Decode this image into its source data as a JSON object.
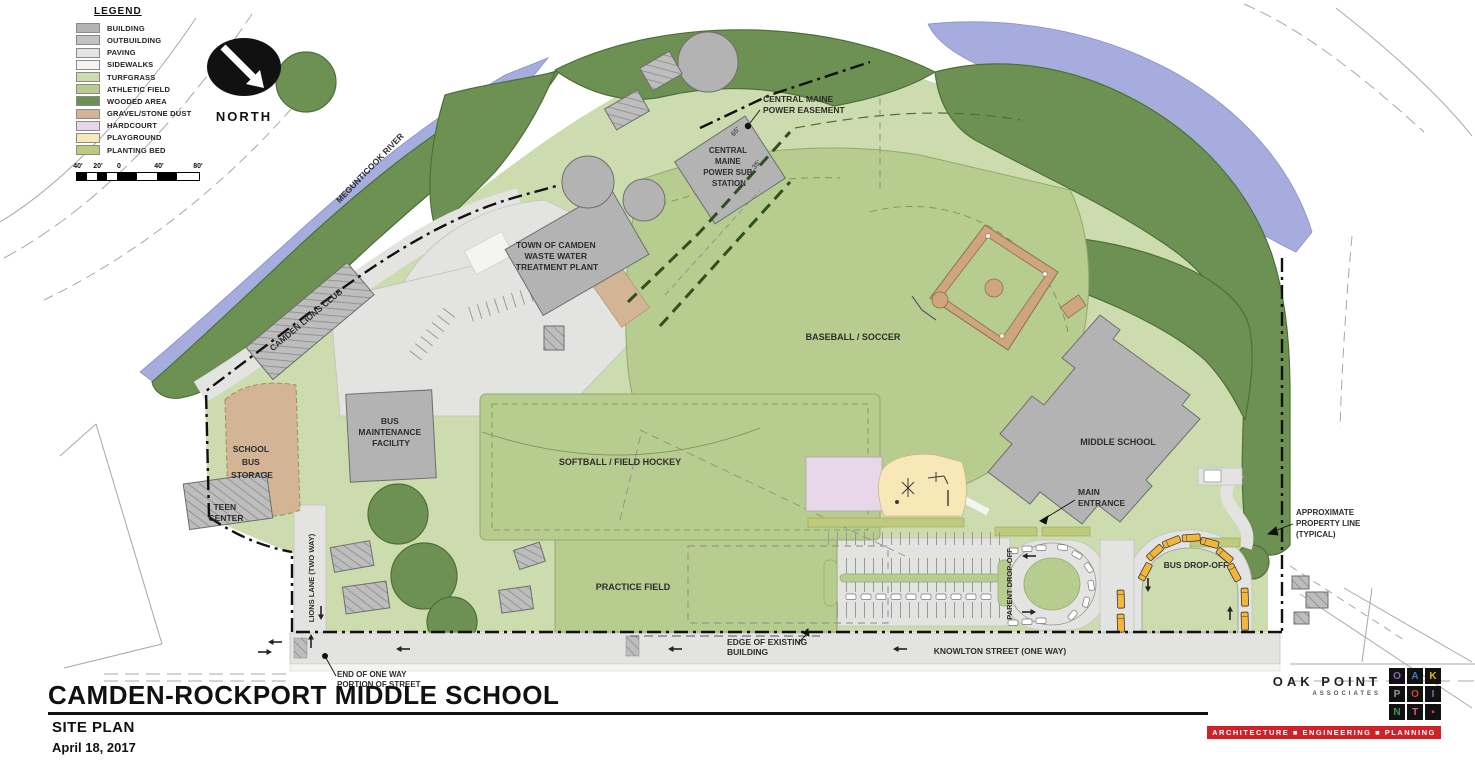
{
  "legend": {
    "title": "LEGEND",
    "items": [
      {
        "label": "BUILDING",
        "color": "#b3b3b3"
      },
      {
        "label": "OUTBUILDING",
        "color": "#c2c2c2"
      },
      {
        "label": "PAVING",
        "color": "#e3e3e1"
      },
      {
        "label": "SIDEWALKS",
        "color": "#f4f4f2"
      },
      {
        "label": "TURFGRASS",
        "color": "#ccdcae"
      },
      {
        "label": "ATHLETIC FIELD",
        "color": "#b7cd8f"
      },
      {
        "label": "WOODED AREA",
        "color": "#6d9053"
      },
      {
        "label": "GRAVEL/STONE DUST",
        "color": "#d3b595"
      },
      {
        "label": "HARDCOURT",
        "color": "#e8d6e9"
      },
      {
        "label": "PLAYGROUND",
        "color": "#f8e7b7"
      },
      {
        "label": "PLANTING BED",
        "color": "#c0ca7d"
      }
    ],
    "scale_ticks": [
      "40'",
      "20'",
      "0",
      "40'",
      "80'"
    ]
  },
  "north_arrow": {
    "label": "NORTH"
  },
  "map": {
    "labels": {
      "river": "MEGUNTICOOK RIVER",
      "power_easement": [
        "CENTRAL MAINE",
        "POWER EASEMENT"
      ],
      "sub_station": [
        "CENTRAL",
        "MAINE",
        "POWER SUB",
        "STATION"
      ],
      "waste_plant": [
        "TOWN OF CAMDEN",
        "WASTE WATER",
        "TREATMENT PLANT"
      ],
      "lions_club": "CAMDEN LIONS CLUB",
      "baseball": "BASEBALL / SOCCER",
      "middle_school": "MIDDLE SCHOOL",
      "bus_storage": [
        "SCHOOL",
        "BUS",
        "STORAGE"
      ],
      "bus_maintenance": [
        "BUS",
        "MAINTENANCE",
        "FACILITY"
      ],
      "teen_center": [
        "TEEN",
        "CENTER"
      ],
      "softball": "SOFTBALL / FIELD HOCKEY",
      "practice": "PRACTICE FIELD",
      "main_entrance": [
        "MAIN",
        "ENTRANCE"
      ],
      "parent_dropoff": "PARENT DROP-OFF",
      "bus_dropoff": "BUS DROP-OFF",
      "lions_lane": "LIONS LANE (TWO WAY)",
      "knowlton": "KNOWLTON STREET (ONE WAY)",
      "edge_building": [
        "EDGE OF EXISTING",
        "BUILDING"
      ],
      "end_one_way": [
        "END OF ONE WAY",
        "PORTION OF STREET"
      ],
      "property_line": [
        "APPROXIMATE",
        "PROPERTY LINE",
        "(TYPICAL)"
      ],
      "dim_65": "65'",
      "dim_35": "35'"
    },
    "colors": {
      "river": "#a6acdd",
      "wooded": "#6d9053",
      "turfgrass": "#ccdcae",
      "athletic_field": "#b7cd8f",
      "building": "#b3b3b3",
      "paving": "#e3e3e1",
      "gravel": "#d3b595",
      "hardcourt": "#e8d6e9",
      "playground": "#f8e7b7",
      "planting_bed": "#c0ca7d",
      "school_bus": "#f2b63a"
    }
  },
  "title_block": {
    "title": "CAMDEN-ROCKPORT MIDDLE SCHOOL",
    "subtitle": "SITE PLAN",
    "date": "April 18, 2017"
  },
  "logo": {
    "name_line1": "OAK POINT",
    "name_line2": "ASSOCIATES",
    "tiles": [
      "O",
      "A",
      "K",
      "P",
      "O",
      "I",
      "N",
      "T",
      "▪"
    ],
    "tile_colors": [
      "#8a6bb8",
      "#3d7dc4",
      "#dfbd1c",
      "#9a9a9a",
      "#cf4437",
      "#8a6bb8",
      "#3f9b4f",
      "#d8607f",
      "#cf4437"
    ],
    "banner": "ARCHITECTURE  ■  ENGINEERING  ■  PLANNING",
    "banner_color": "#cf2128"
  }
}
